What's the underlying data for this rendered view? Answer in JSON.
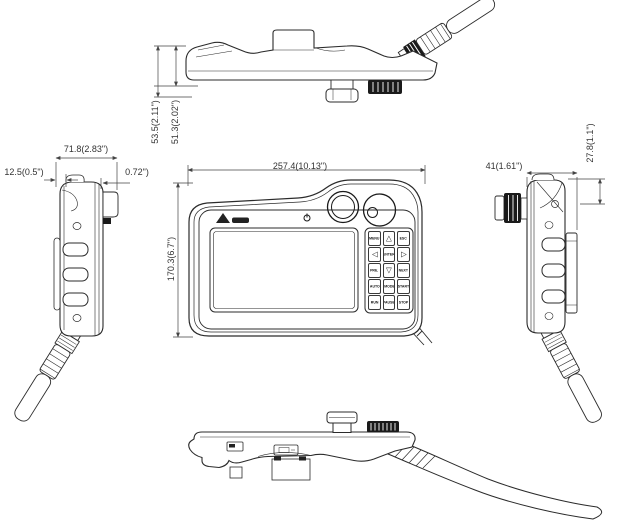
{
  "dimension_labels": {
    "top_view": {
      "overall_depth": "53.5(2.11\")",
      "body_depth": "51.3(2.02\")"
    },
    "left_view": {
      "width": "71.8(2.83\")",
      "grip_offset": "12.5(0.5\")",
      "step": "0.72\")"
    },
    "front_view": {
      "width": "257.4(10.13\")",
      "height": "170.3(6.7\")"
    },
    "right_view": {
      "width": "41(1.61\")",
      "step_height": "27.8(1.1\")"
    }
  },
  "front_panel": {
    "keypad_buttons": [
      "MENU",
      "△",
      "ESC",
      "◁",
      "ENTER",
      "▷",
      "PRE.",
      "▽",
      "NEXT",
      "AUTO",
      "MODE",
      "START",
      "RUN",
      "PAUSE",
      "STOP"
    ]
  },
  "icons": {
    "power": "power-icon",
    "emergency_stop": "emergency-stop-button",
    "selector_dial": "selector-dial",
    "usb": "usb-port",
    "logo": "brand-logo"
  }
}
